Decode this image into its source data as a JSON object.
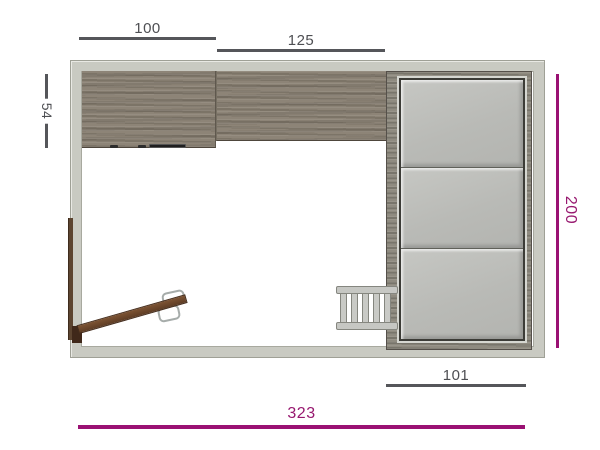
{
  "diagram": {
    "type": "room-floor-plan-top-view",
    "labels": {
      "cabinet_left_width": "100",
      "cabinet_right_width": "125",
      "cabinet_depth": "54",
      "room_depth": "200",
      "wardrobe_width": "101",
      "room_width": "323"
    },
    "colors": {
      "dimension_gray": "#55565a",
      "dimension_magenta": "#9a1173",
      "wall": "#c9cac2",
      "wood_cabinet": "#8d8477",
      "wardrobe_doors": "#bfc0bc",
      "door_wood": "#6d4a31",
      "background": "#ffffff"
    }
  }
}
